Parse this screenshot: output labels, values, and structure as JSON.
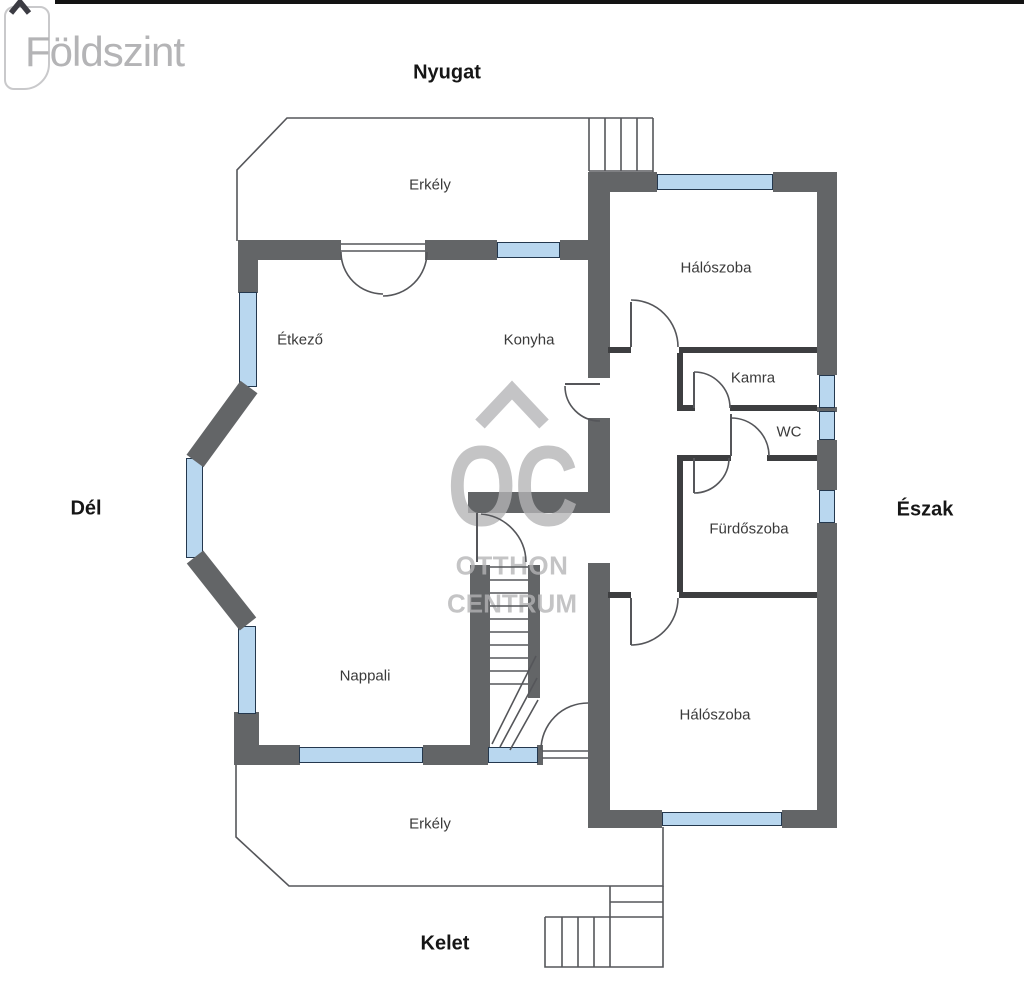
{
  "header": {
    "floor_label": "Földszint"
  },
  "compass": {
    "west": "Nyugat",
    "south": "Dél",
    "north": "Észak",
    "east": "Kelet"
  },
  "rooms": {
    "erkely_top": "Erkély",
    "etkezo": "Étkező",
    "konyha": "Konyha",
    "haloszoba_1": "Hálószoba",
    "kamra": "Kamra",
    "wc": "WC",
    "furdoszoba": "Fürdőszoba",
    "nappali": "Nappali",
    "haloszoba_2": "Hálószoba",
    "erkely_bottom": "Erkély"
  },
  "watermark": {
    "monogram": "OC",
    "name_line1": "OTTHON",
    "name_line2": "CENTRUM"
  },
  "colors": {
    "wall": "#636567",
    "interior_wall": "#3d3e40",
    "window_fill": "#b9d7ef",
    "window_border": "#24384e",
    "line": "#55565a",
    "accent_text": "#161616",
    "room_text": "#3a3a3a",
    "watermark_gray": "#b4b4b6",
    "bar": "#131313"
  }
}
